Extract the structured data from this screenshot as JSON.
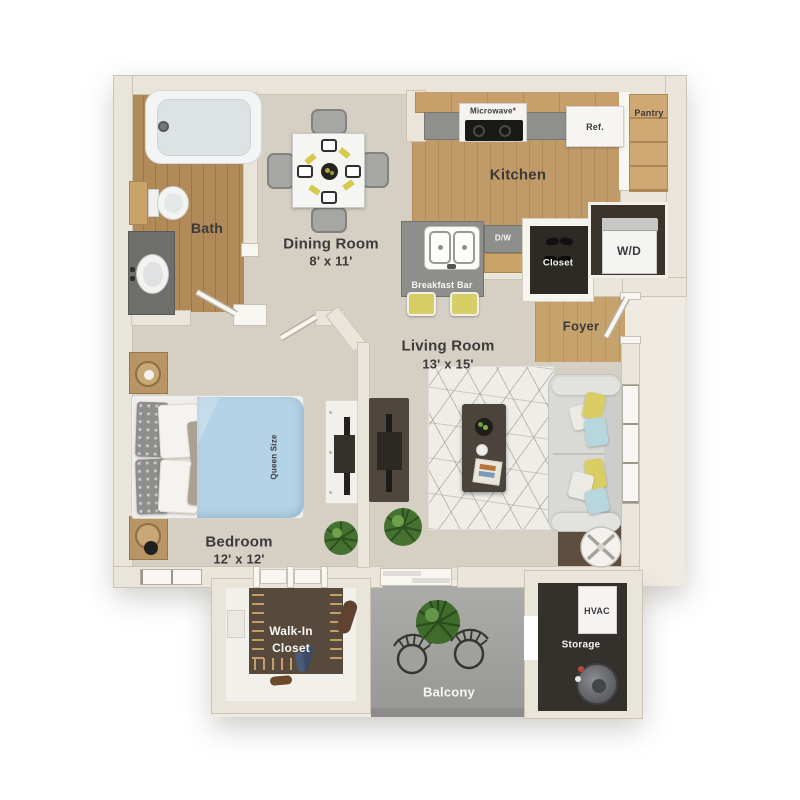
{
  "rooms": {
    "bath": {
      "label": "Bath"
    },
    "dining": {
      "label": "Dining Room",
      "dims": "8' x 11'"
    },
    "kitchen": {
      "label": "Kitchen"
    },
    "living": {
      "label": "Living Room",
      "dims": "13' x 15'"
    },
    "bedroom": {
      "label": "Bedroom",
      "dims": "12' x 12'"
    },
    "foyer": {
      "label": "Foyer"
    },
    "walk_in_closet": {
      "line1": "Walk-In",
      "line2": "Closet"
    },
    "balcony": {
      "label": "Balcony"
    },
    "storage": {
      "label": "Storage"
    }
  },
  "fixtures": {
    "microwave": "Microwave*",
    "refrigerator": "Ref.",
    "pantry": "Pantry",
    "dishwasher": "D/W",
    "closet": "Closet",
    "washer_dryer": "W/D",
    "breakfast_bar": "Breakfast Bar",
    "hvac": "HVAC",
    "bed_size": "Queen Size"
  },
  "colors": {
    "wall": "#eae5db",
    "floor_beige": "#d6cfc3",
    "floor_wood": "#c09a67",
    "floor_dark": "#34302b",
    "balcony_floor": "#a4a4a2",
    "bed_duvet": "#b5d3e6",
    "accent_yellow": "#d7cf66",
    "accent_blue": "#b7d6dd",
    "label_dark": "#3b3b3b",
    "label_light": "#f6f6f4"
  }
}
